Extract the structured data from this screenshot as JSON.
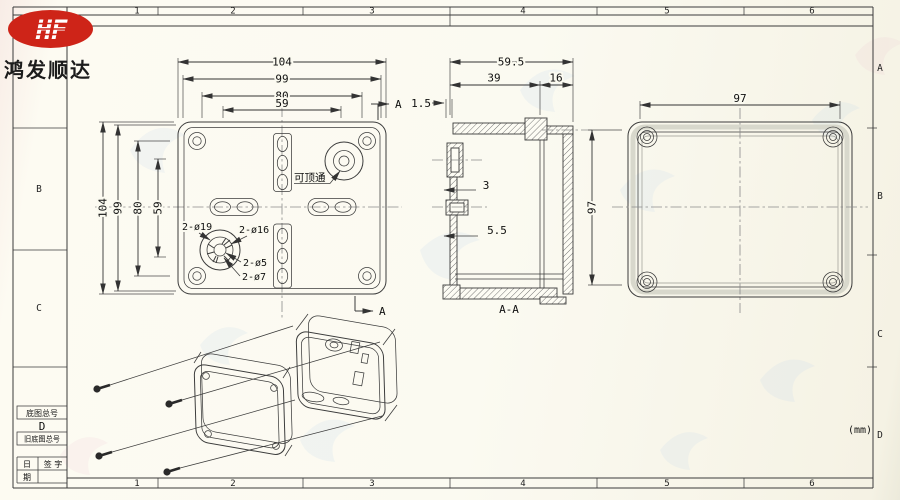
{
  "brand": {
    "logo_text": "HF",
    "company_name": "鸿发顺达"
  },
  "grid": {
    "cols": [
      "1",
      "2",
      "3",
      "4",
      "5",
      "6"
    ],
    "rows_right": [
      "A",
      "B",
      "C",
      "D"
    ],
    "rows_left": [
      "B",
      "C"
    ]
  },
  "title_block": {
    "base_no_label": "底图总号",
    "grid_letter": "D",
    "old_base_no_label": "旧底图总号",
    "date_top": "日",
    "date_bottom": "期",
    "sign_label": "签 字"
  },
  "front_view": {
    "dim_outer": "104",
    "dim_99": "99",
    "dim_80": "80",
    "dim_59": "59",
    "label_knockout": "可顶通",
    "label_d19": "2-ø19",
    "label_d16": "2-ø16",
    "label_d5": "2-ø5",
    "label_d7": "2-ø7",
    "section_letter": "A"
  },
  "section_view": {
    "dim_depth": "59.5",
    "dim_body": "39",
    "dim_lid": "16",
    "dim_lip": "1.5",
    "dim_boss1": "3",
    "dim_boss2": "5.5",
    "label": "A-A"
  },
  "back_view": {
    "dim_width": "97",
    "dim_height": "97"
  },
  "notes": {
    "units": "(mm)"
  }
}
